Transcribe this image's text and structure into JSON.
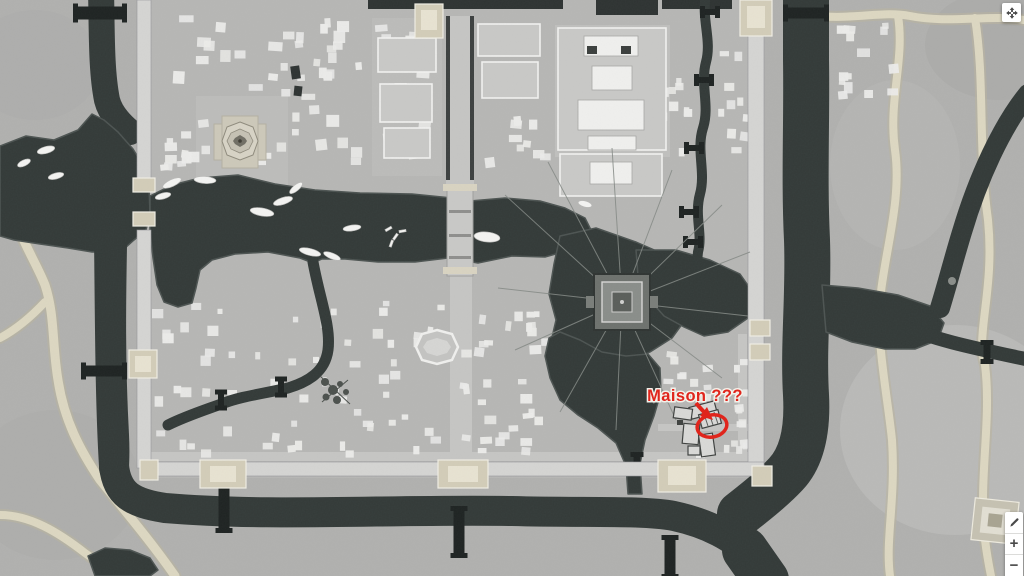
{
  "annotation": {
    "label": "Maison ???",
    "color": "#e0251c"
  },
  "controls": {
    "fullscreen": {
      "icon": "fullscreen-arrows-icon"
    },
    "edit": {
      "icon": "pencil-icon"
    },
    "zoom_in": {
      "label": "+"
    },
    "zoom_out": {
      "label": "−"
    }
  },
  "map": {
    "description": "grayscale walled-city game map with moat and canals",
    "palette": {
      "countryside": "#b1b1af",
      "city_ground": "#b7b7b5",
      "water": "#333a38",
      "water_edge": "#4d5452",
      "building": "#ececea",
      "path": "#ddd8c2",
      "path_edge": "#bab5a1",
      "wall": "#d5d5d3",
      "gate": "#d3cdb9",
      "bridge": "#1e2322",
      "street": "#c6c6c4",
      "annotation_red": "#e0251c",
      "button_bg": "#ffffff",
      "icon_color": "#4a4a4a"
    }
  }
}
